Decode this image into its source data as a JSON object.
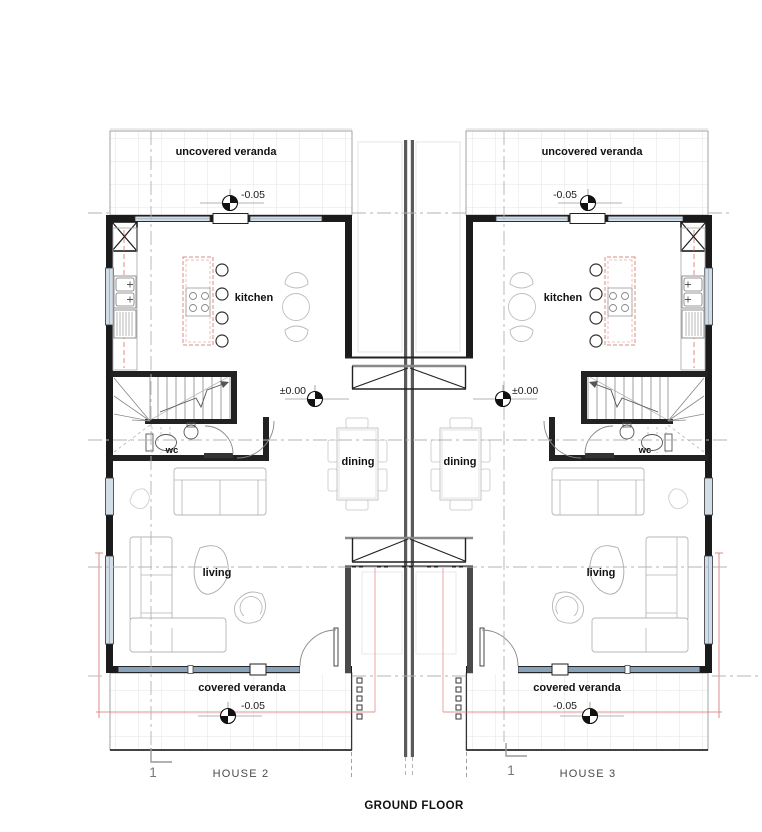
{
  "drawing": {
    "title": "GROUND FLOOR",
    "type": "architectural-floor-plan",
    "icons": {
      "level_marker": "survey-level-benchmark-icon",
      "column": "crossed-column-icon",
      "stair_direction": "stair-up-arrow-icon"
    }
  },
  "houses": [
    {
      "name": "HOUSE 2",
      "section_marker": "1",
      "labels": {
        "uncovered_veranda": "uncovered veranda",
        "covered_veranda": "covered veranda",
        "kitchen": "kitchen",
        "wc": "wc",
        "dining": "dining",
        "living": "living"
      },
      "levels": {
        "front_veranda": "-0.05",
        "interior": "±0.00",
        "rear_veranda": "-0.05"
      }
    },
    {
      "name": "HOUSE 3",
      "section_marker": "1",
      "labels": {
        "uncovered_veranda": "uncovered veranda",
        "covered_veranda": "covered veranda",
        "kitchen": "kitchen",
        "wc": "wc",
        "dining": "dining",
        "living": "living"
      },
      "levels": {
        "front_veranda": "-0.05",
        "interior": "±0.00",
        "rear_veranda": "-0.05"
      }
    }
  ],
  "palette": {
    "wall": "#1b1b1b",
    "party_wall": "#5a5a5a",
    "glazing_light": "#d3dde8",
    "glazing_dark": "#8ba3b8",
    "tile_grid": "#dcdcdc",
    "furniture": "#b5b5b5",
    "fixture": "#555555",
    "island_accent": "#d98f86",
    "roof_overhang": "#d9726b",
    "axis": "#b3b3b3",
    "annotation": "#888888"
  }
}
